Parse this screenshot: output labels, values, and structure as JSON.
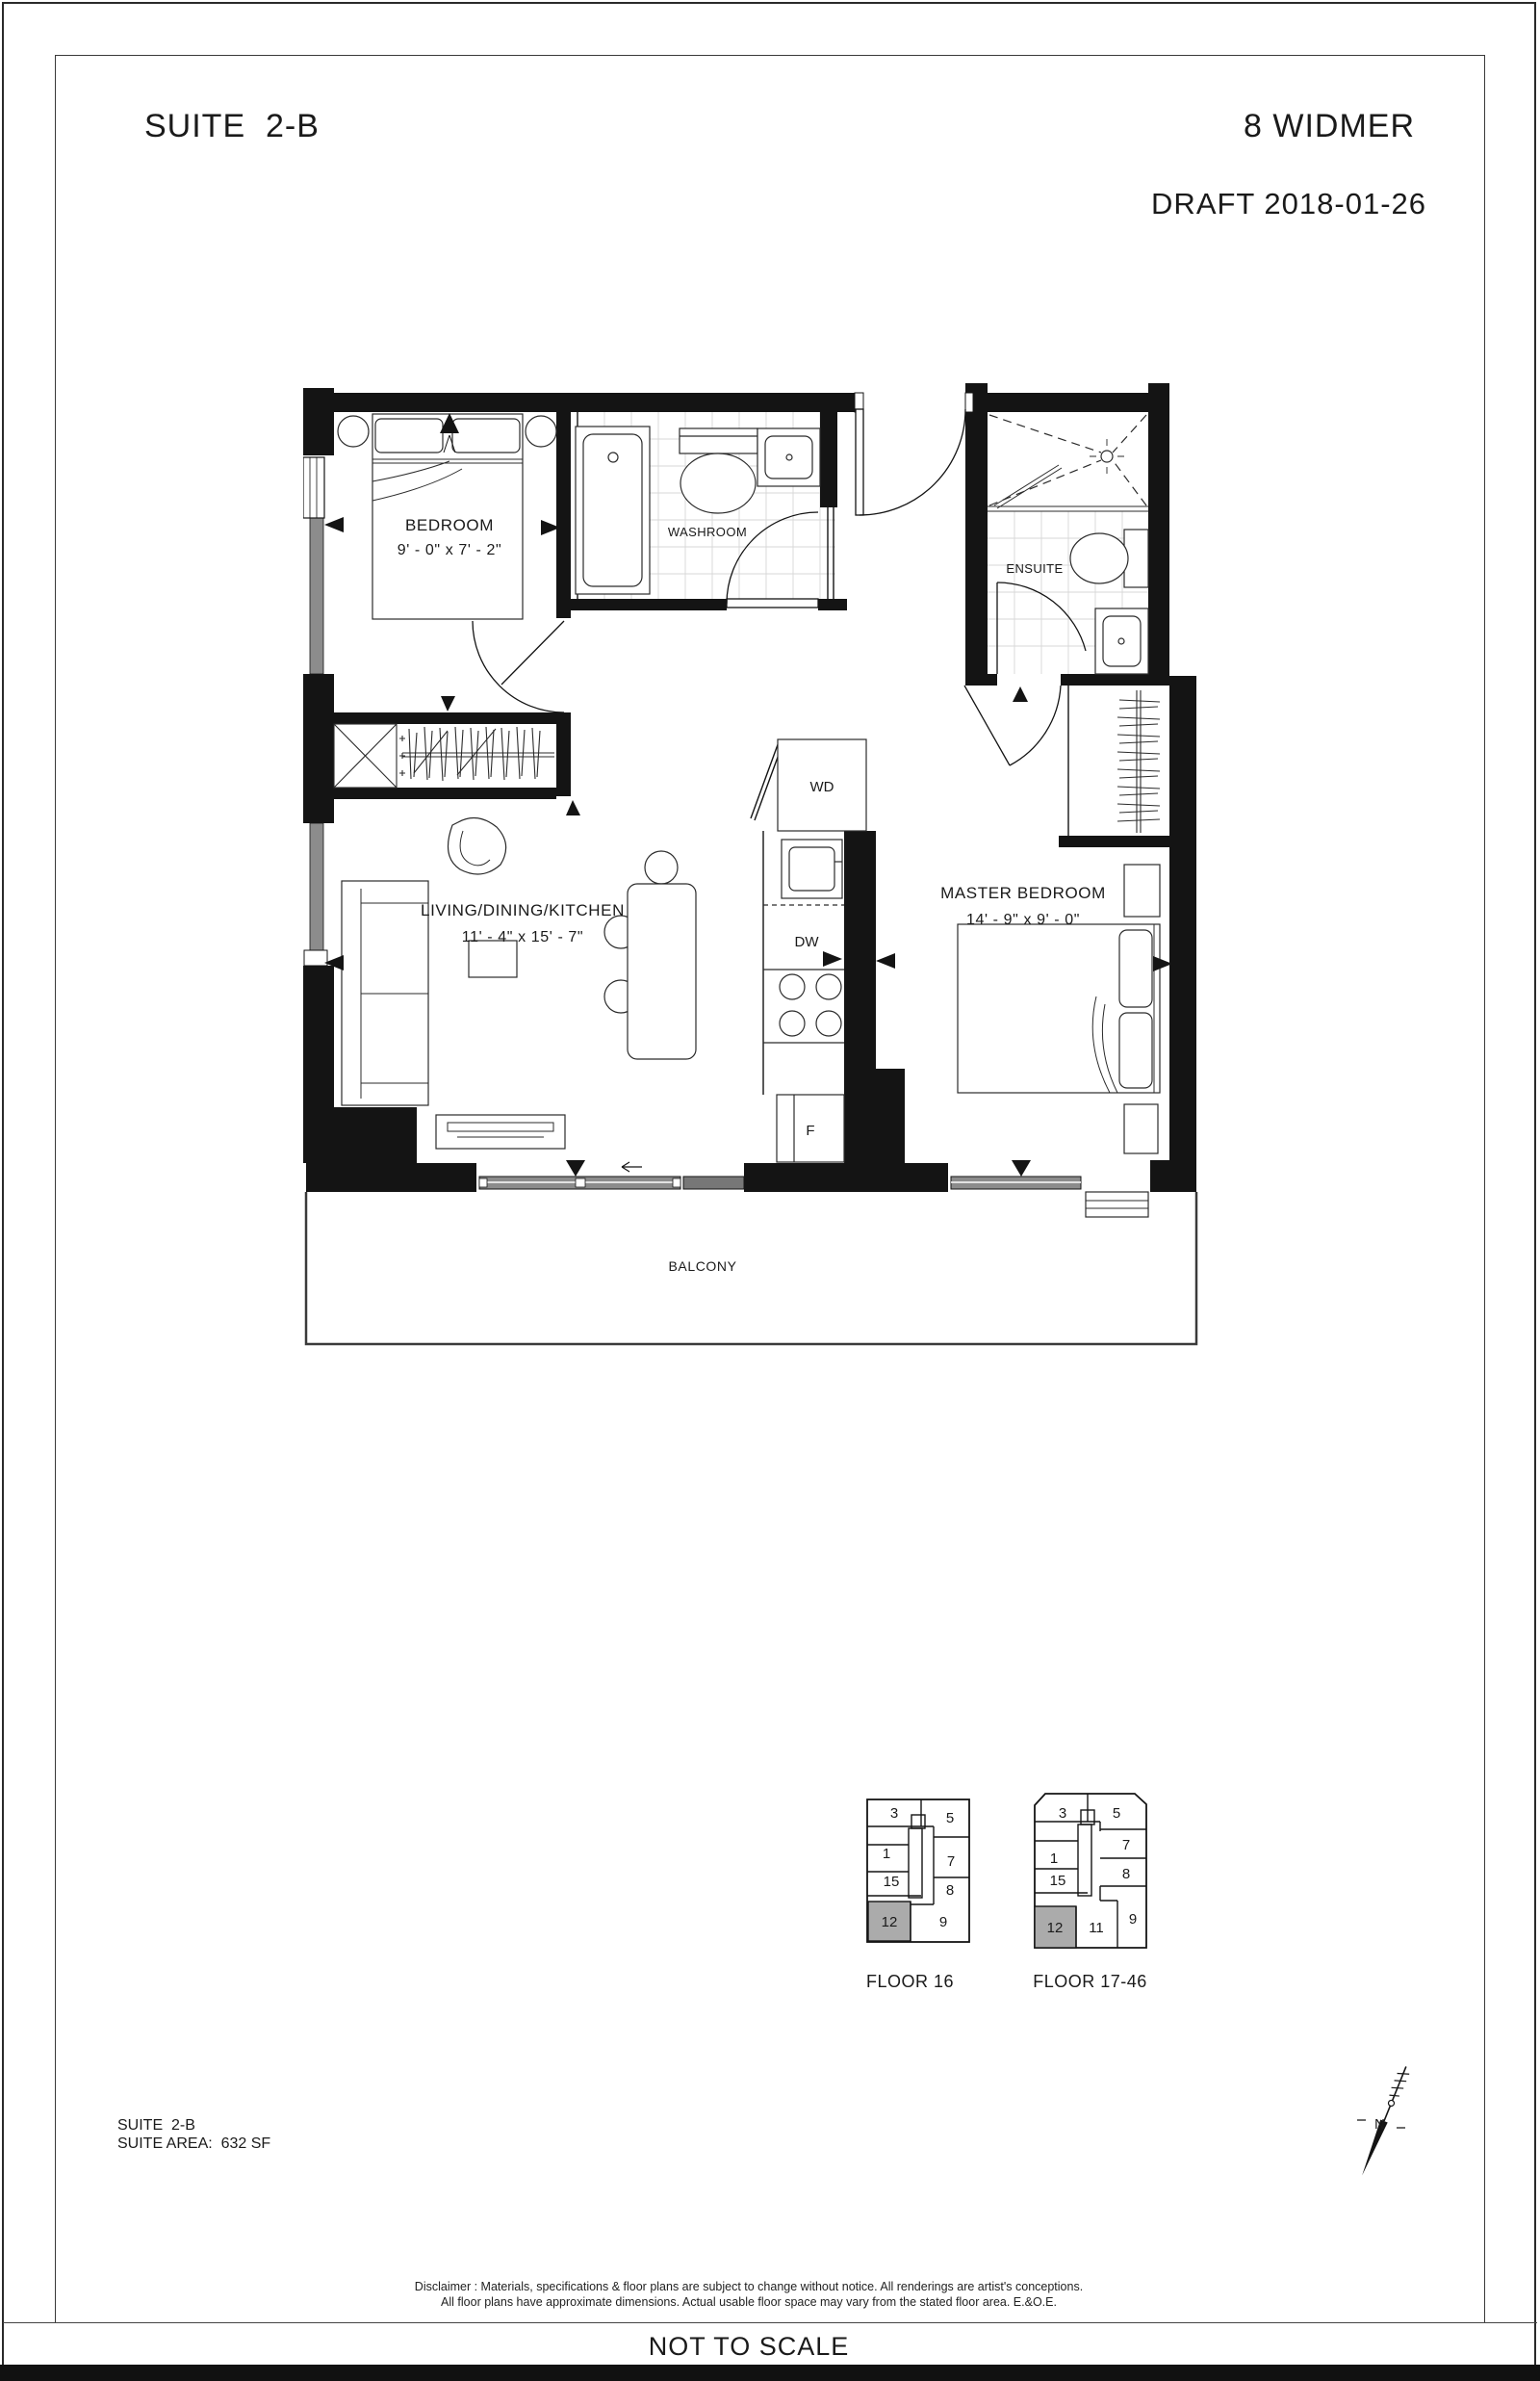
{
  "header": {
    "suite": "SUITE  2-B",
    "building": "8 WIDMER",
    "draft": "DRAFT 2018-01-26"
  },
  "plan": {
    "rooms": {
      "bedroom": {
        "name": "BEDROOM",
        "dims": "9' - 0\" x  7' - 2\""
      },
      "washroom": {
        "name": "WASHROOM"
      },
      "ensuite": {
        "name": "ENSUITE"
      },
      "living": {
        "name": "LIVING/DINING/KITCHEN",
        "dims": "11' - 4\" x  15' - 7\""
      },
      "master": {
        "name": "MASTER BEDROOM",
        "dims": "14' - 9\" x  9' - 0\""
      },
      "balcony": {
        "name": "BALCONY"
      }
    },
    "labels": {
      "wd": "WD",
      "dw": "DW",
      "fridge": "F"
    }
  },
  "keyplans": [
    {
      "label": "FLOOR 16",
      "highlighted_unit": "12",
      "units": [
        "3",
        "5",
        "1",
        "7",
        "15",
        "8",
        "12",
        "9"
      ]
    },
    {
      "label": "FLOOR 17-46",
      "highlighted_unit": "12",
      "units": [
        "3",
        "5",
        "1",
        "7",
        "15",
        "8",
        "12",
        "11",
        "9"
      ]
    }
  ],
  "footer": {
    "suite_label": "SUITE  2-B",
    "area_label": "SUITE AREA:  632 SF",
    "disclaimer1": "Disclaimer : Materials, specifications & floor plans are subject to change without notice. All renderings are artist's conceptions.",
    "disclaimer2": "All floor plans have approximate dimensions. Actual usable floor space may vary from the stated floor area. E.&O.E.",
    "scale": "NOT TO SCALE"
  },
  "north": {
    "label": "N"
  },
  "colors": {
    "wall": "#141414",
    "window_gray": "#8c8c8c",
    "panel_gray": "#777777",
    "keyplan_highlight": "#ababab"
  }
}
